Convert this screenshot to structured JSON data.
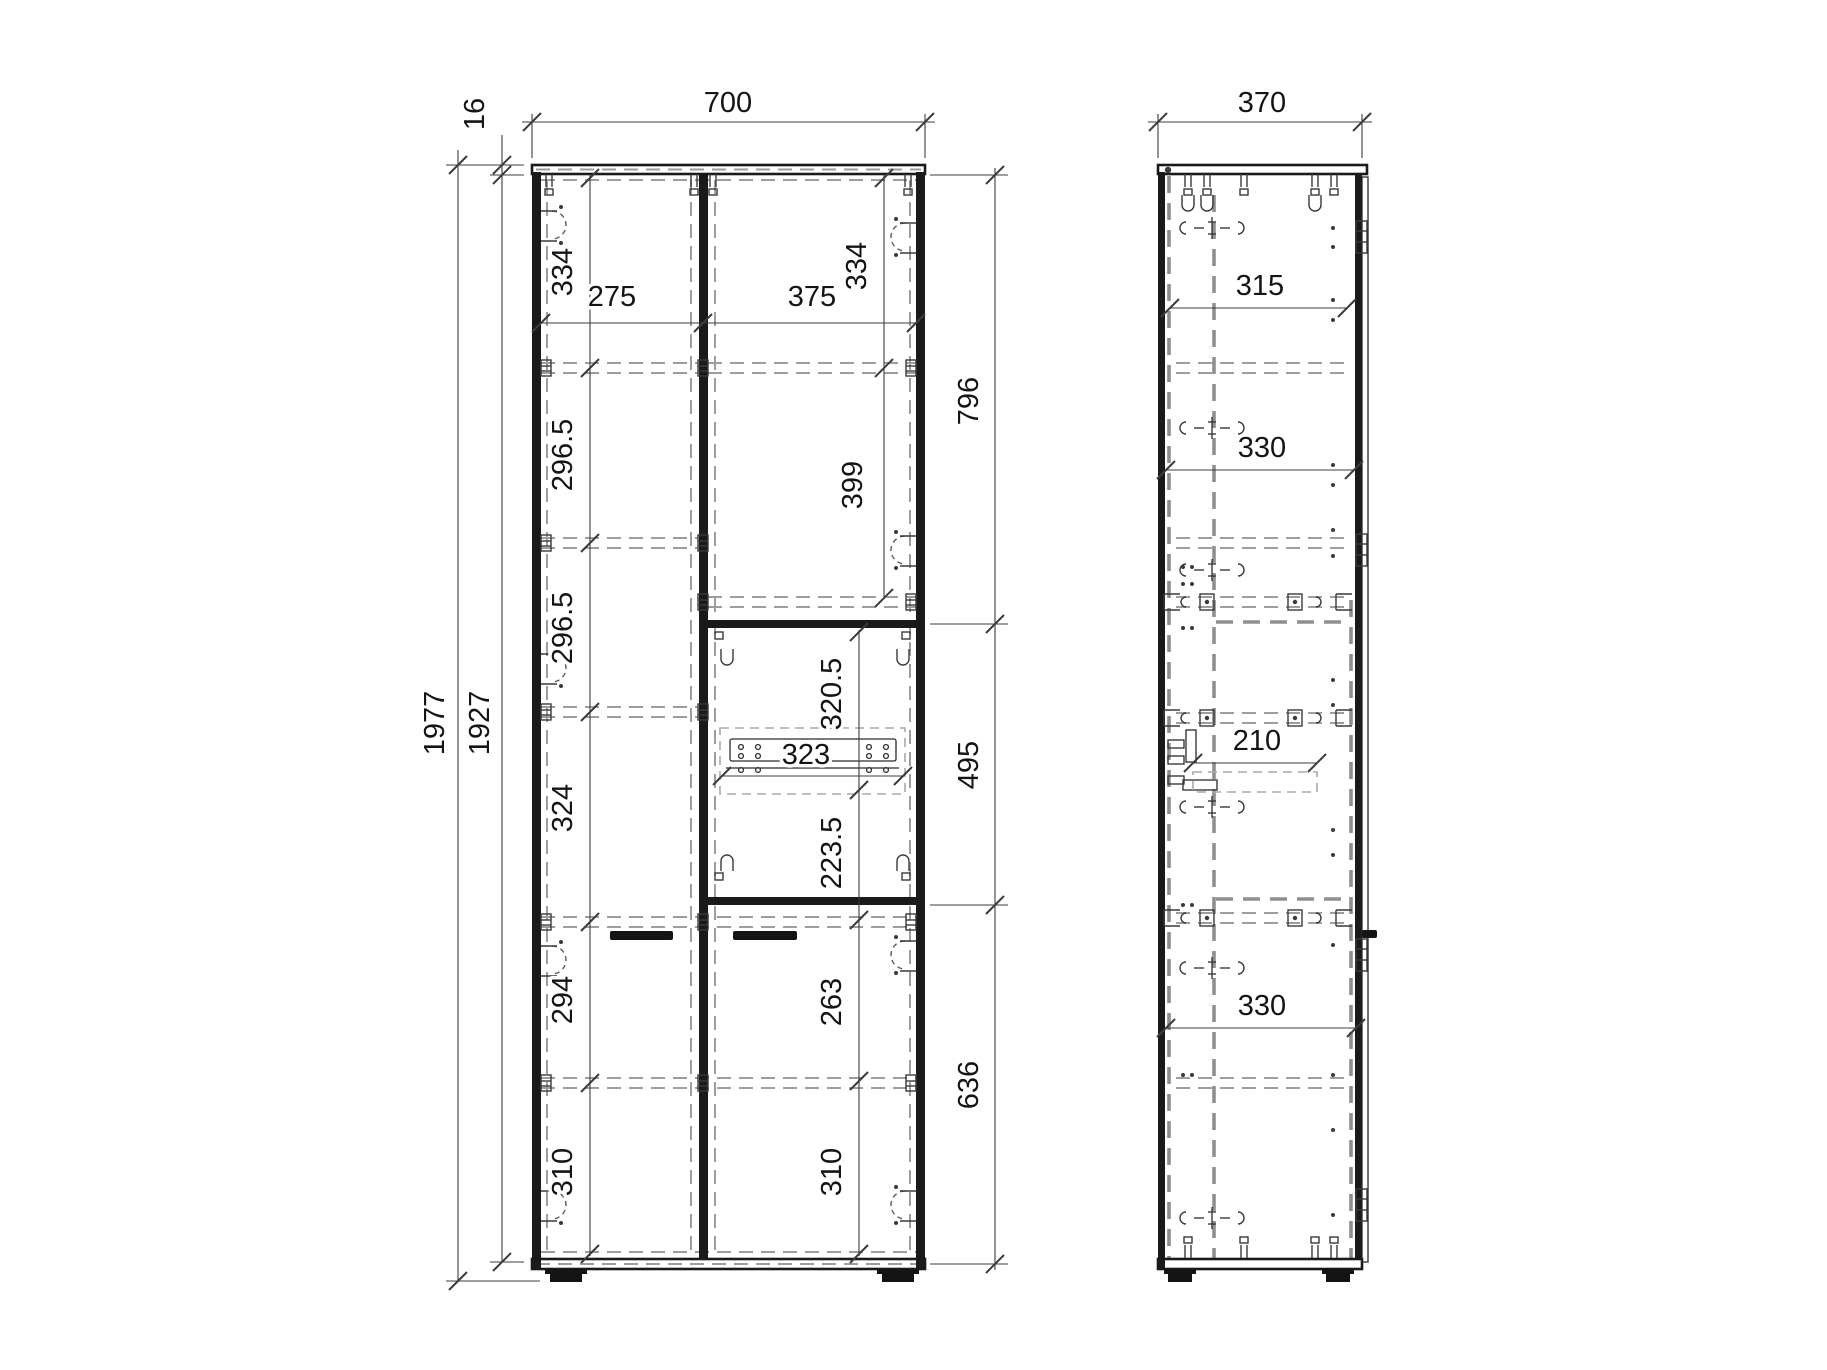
{
  "sheet": {
    "background": "#ffffff",
    "outline_color": "#1a1a1a",
    "hidden_line_color": "#9a9a9a",
    "dimension_color": "#3c3c3c"
  },
  "front_view": {
    "overall_width": "700",
    "top_panel_thickness": "16",
    "total_height": "1977",
    "carcass_height": "1927",
    "left_opening_width": "275",
    "right_opening_width": "375",
    "left_shelf_spacings": [
      "334",
      "296.5",
      "296.5",
      "324",
      "294",
      "310"
    ],
    "right_top_spacing": "334",
    "right_upper_opening": "399",
    "niche_upper_height": "320.5",
    "drawer_rail_width": "323",
    "niche_lower_height": "223.5",
    "right_lower_opening": "263",
    "right_bottom_spacing": "310",
    "right_section_heights": [
      "796",
      "495",
      "636"
    ]
  },
  "side_view": {
    "overall_depth": "370",
    "top_clear_depth": "315",
    "upper_shelf_depth": "330",
    "drawer_rail_depth": "210",
    "lower_shelf_depth": "330"
  }
}
